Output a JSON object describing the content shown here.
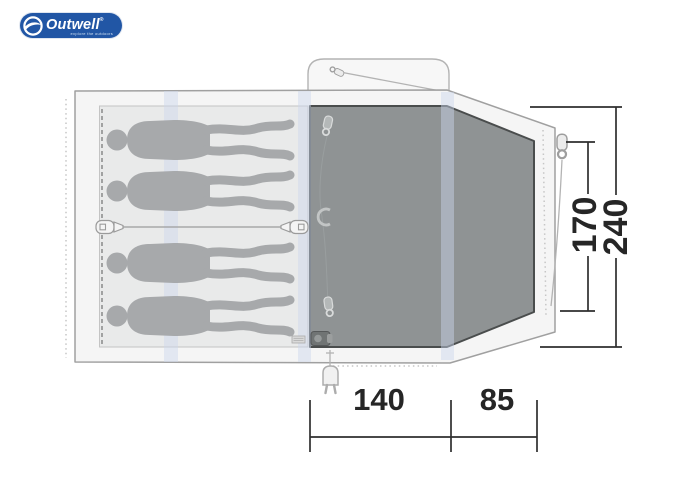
{
  "logo": {
    "brand": "Outwell",
    "registered_mark": "®",
    "tagline": "explore the outdoors",
    "pill_color": "#2156a5",
    "text_color": "#ffffff"
  },
  "floorplan": {
    "sleeping_capacity": 4,
    "dimensions": {
      "side_inner": "170",
      "side_outer": "240",
      "bottom_living": "140",
      "bottom_porch": "85"
    },
    "colors": {
      "tent_fill": "#f5f5f5",
      "tent_outline": "#a0a0a0",
      "sleeping_area_fill": "#e9eaea",
      "living_floor_fill": "#8f9394",
      "living_floor_outline": "#4a4d4d",
      "silhouette": "#a7a9ab",
      "pole_band": "#ccd7ee",
      "dimension_ink": "#2e2e2e"
    },
    "icons": {
      "zipper_pull": "zip-slider glyph (rounded tab + ring)",
      "tie_toggle": "divider tie toggle (rounded tab + arrow)",
      "c_hook": "C-shaped lantern hook",
      "power_plug": "two-pin electric plug",
      "guy_line": "thin guy-rope line",
      "swoosh": "brand globe swoosh"
    }
  }
}
